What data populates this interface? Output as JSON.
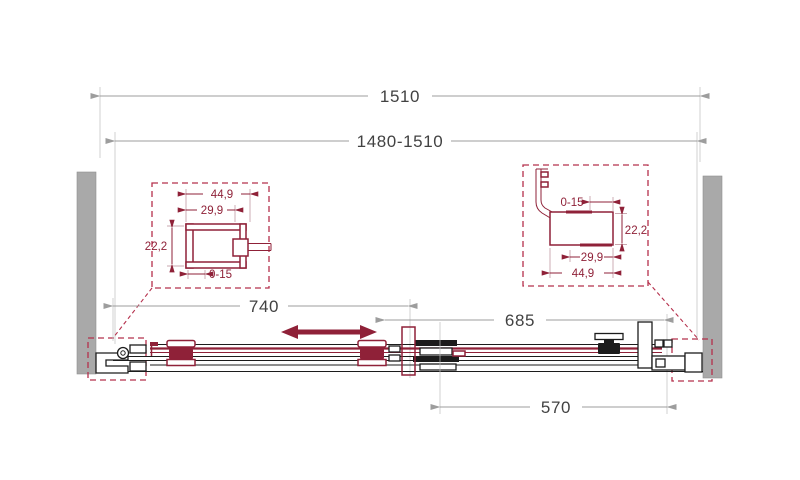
{
  "drawing": {
    "kind": "sliding-shower-door-plan-view",
    "dims": {
      "overall": "1510",
      "adjustable": "1480-1510",
      "door": "740",
      "panel": "685",
      "glass": "570"
    },
    "detail_left": {
      "outer_width": "44,9",
      "inner_width": "29,9",
      "height": "22,2",
      "adjustment": "0-15"
    },
    "detail_right": {
      "adjustment": "0-15",
      "height": "22,2",
      "inner_width": "29,9",
      "outer_width": "44,9"
    },
    "colors": {
      "accent_maroon": "#8f2138",
      "dashed_red": "#b5304c",
      "dimension_gray": "#9d9d9d",
      "text_dark": "#424242",
      "wall_gray": "#a9a9a9",
      "line_black": "#1c1c1c"
    }
  }
}
